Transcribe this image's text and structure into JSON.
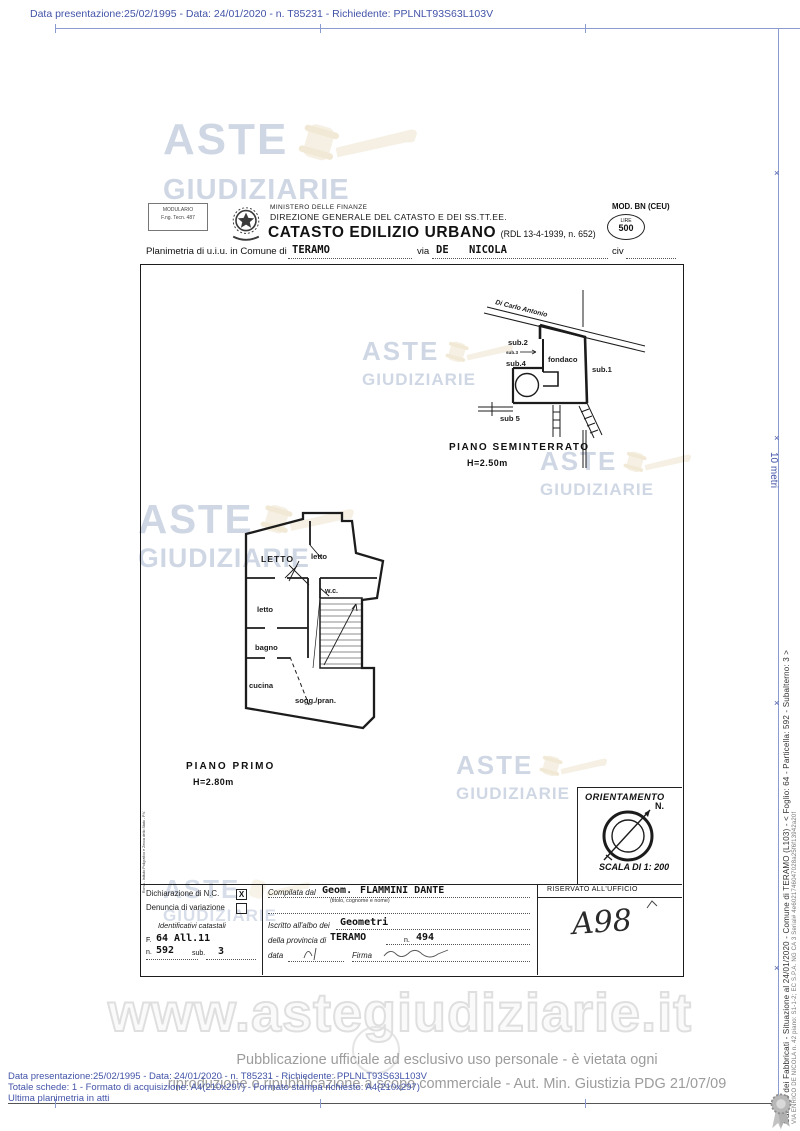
{
  "scan": {
    "top_meta": "Data presentazione:25/02/1995 - Data: 24/01/2020 - n. T85231 - Richiedente: PPLNLT93S63L103V",
    "ruler_label": "10 metri"
  },
  "watermark": {
    "aste": "ASTE",
    "giudiziarie": "GIUDIZIARIE",
    "site": "www.astegiudiziarie.it"
  },
  "header": {
    "modulario_line1": "MODULARIO",
    "modulario_line2": "F.ng. Tecn. 487",
    "ministero": "MINISTERO DELLE FINANZE",
    "direzione": "DIREZIONE GENERALE DEL CATASTO E DEI SS.TT.EE.",
    "catasto_title": "CATASTO EDILIZIO URBANO",
    "catasto_ref": "(RDL 13-4-1939, n. 652)",
    "mod": "MOD. BN (CEU)",
    "lire_label": "LIRE",
    "lire_value": "500",
    "planimetria_label": "Planimetria di u.i.u. in Comune di",
    "comune_value": "TERAMO",
    "via_label": "via",
    "via_value": "DE NICOLA",
    "civ_label": "civ"
  },
  "plan_upper": {
    "owner": "Di Carlo Antonio",
    "sub2": "sub.2",
    "sub3": "sub.3",
    "fondaco": "fondaco",
    "sub4": "sub.4",
    "sub1": "sub.1",
    "sub5": "sub 5",
    "title": "PIANO SEMINTERRATO",
    "height": "H=2.50m"
  },
  "plan_lower": {
    "room_letto_caps": "LETTO",
    "room_letto_tr": "letto",
    "room_letto_mid": "letto",
    "room_wc": "w.c.",
    "room_bagno": "bagno",
    "room_cucina": "cucina",
    "room_sogg": "sogg./pran.",
    "title": "PIANO PRIMO",
    "height": "H=2.80m"
  },
  "orientation": {
    "title": "ORIENTAMENTO",
    "north": "N.",
    "scale": "SCALA DI 1: 200"
  },
  "margin_note": "Roma - Istituto Poligrafico e Zecca dello Stato - P.V.",
  "form": {
    "dichiarazione": "Dichiarazione di N.C.",
    "dichiarazione_check": "X",
    "denuncia": "Denuncia di variazione",
    "identificativi": "Identificativi catastali",
    "f_label": "F.",
    "f_value": "64 All.11",
    "n_label": "n.",
    "n_value": "592",
    "sub_label": "sub.",
    "sub_value": "3",
    "compilata_label": "Compilata dal",
    "geom_label": "Geom.",
    "name_value": "FLAMMINI DANTE",
    "name_hint": "(titolo, cognome e nome)",
    "iscritto_label": "Iscritto all'albo dei",
    "albo_value": "Geometri",
    "provincia_label": "della provincia di",
    "provincia_value": "TERAMO",
    "n2_label": "n.",
    "n2_value": "494",
    "data_label": "data",
    "firma_label": "Firma",
    "riservato": "RISERVATO ALL'UFFICIO",
    "riservato_value": "A98"
  },
  "footer": {
    "line1": "Pubblicazione ufficiale ad esclusivo uso personale - è vietata ogni",
    "line2": "riproduzione o ripubblicazione a scopo commerciale - Aut. Min. Giustizia PDG 21/07/09",
    "meta1": "Data presentazione:25/02/1995 - Data: 24/01/2020 - n. T85231 - Richiedente: PPLNLT93S63L103V",
    "meta2": "Totale schede: 1 - Formato di acquisizione: A4(210x297) - Formato stampa richiesto: A4(210x297)",
    "meta3": "Ultima planimetria in atti"
  },
  "sidebar": {
    "line1": "Catasto dei Fabbricati - Situazione al 24/01/2020 - Comune di TERAMO (L103) - < Foglio: 64 - Particella: 592 - Subalterno: 3 >",
    "line2": "VIA ENRICO DE NICOLA n. 42 piano: S1-1-2; EC S.P.A. NG CA 3 Serial# 4e6021746047028a25f6f13942a20f"
  },
  "colors": {
    "annotation_blue": "#4253a8",
    "ruler_blue": "#8b9bd0",
    "watermark_blue": "#a9b8cf",
    "gavel_beige": "#e9dcbf",
    "ink_black": "#1c1c1c",
    "footer_gray": "#9c9c9c"
  }
}
